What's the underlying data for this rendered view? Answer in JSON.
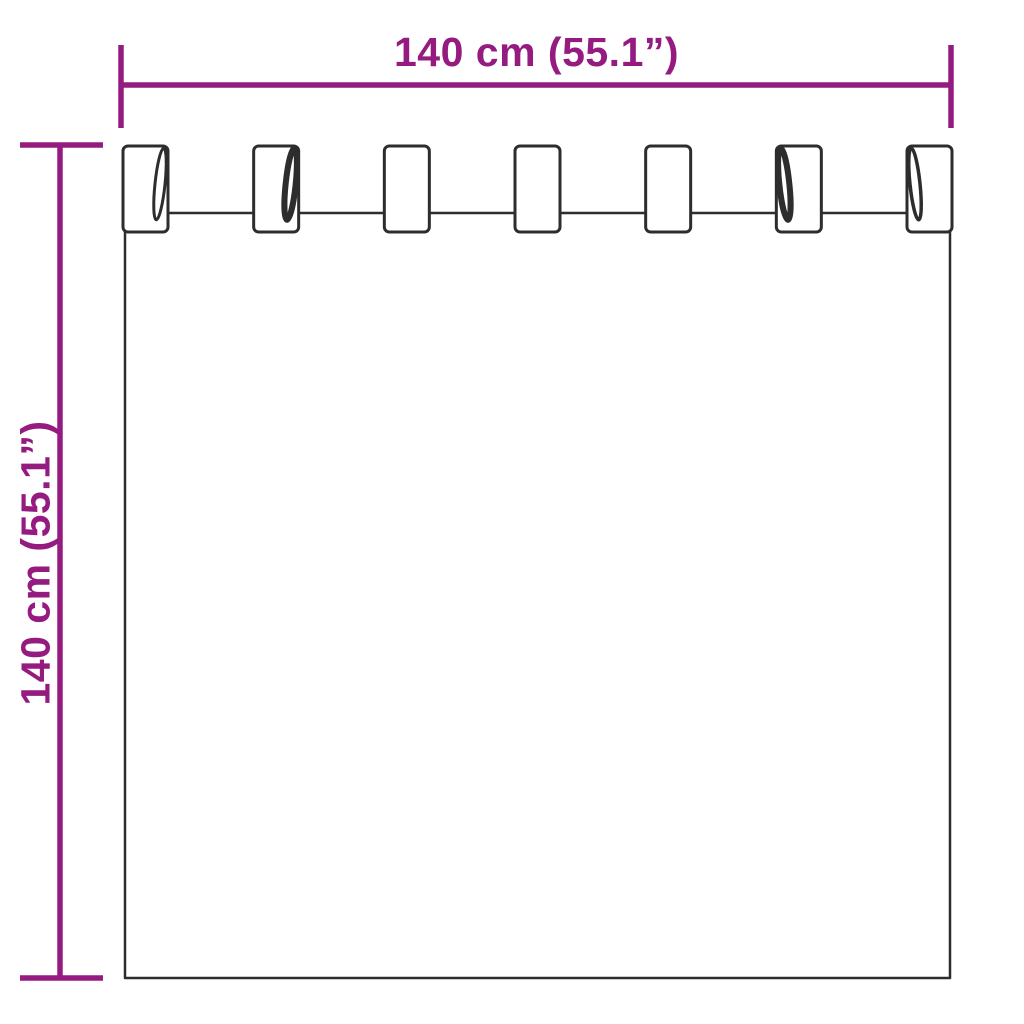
{
  "page": {
    "background": "#ffffff"
  },
  "colors": {
    "dimension_accent": "#951b81",
    "drawing_outline": "#2d2d2d"
  },
  "dimensions": {
    "width": {
      "label": "140 cm (55.1”)"
    },
    "height": {
      "label": "140 cm (55.1”)"
    }
  },
  "diagram": {
    "subject": "tab-top-curtain",
    "tab_count": 7
  }
}
